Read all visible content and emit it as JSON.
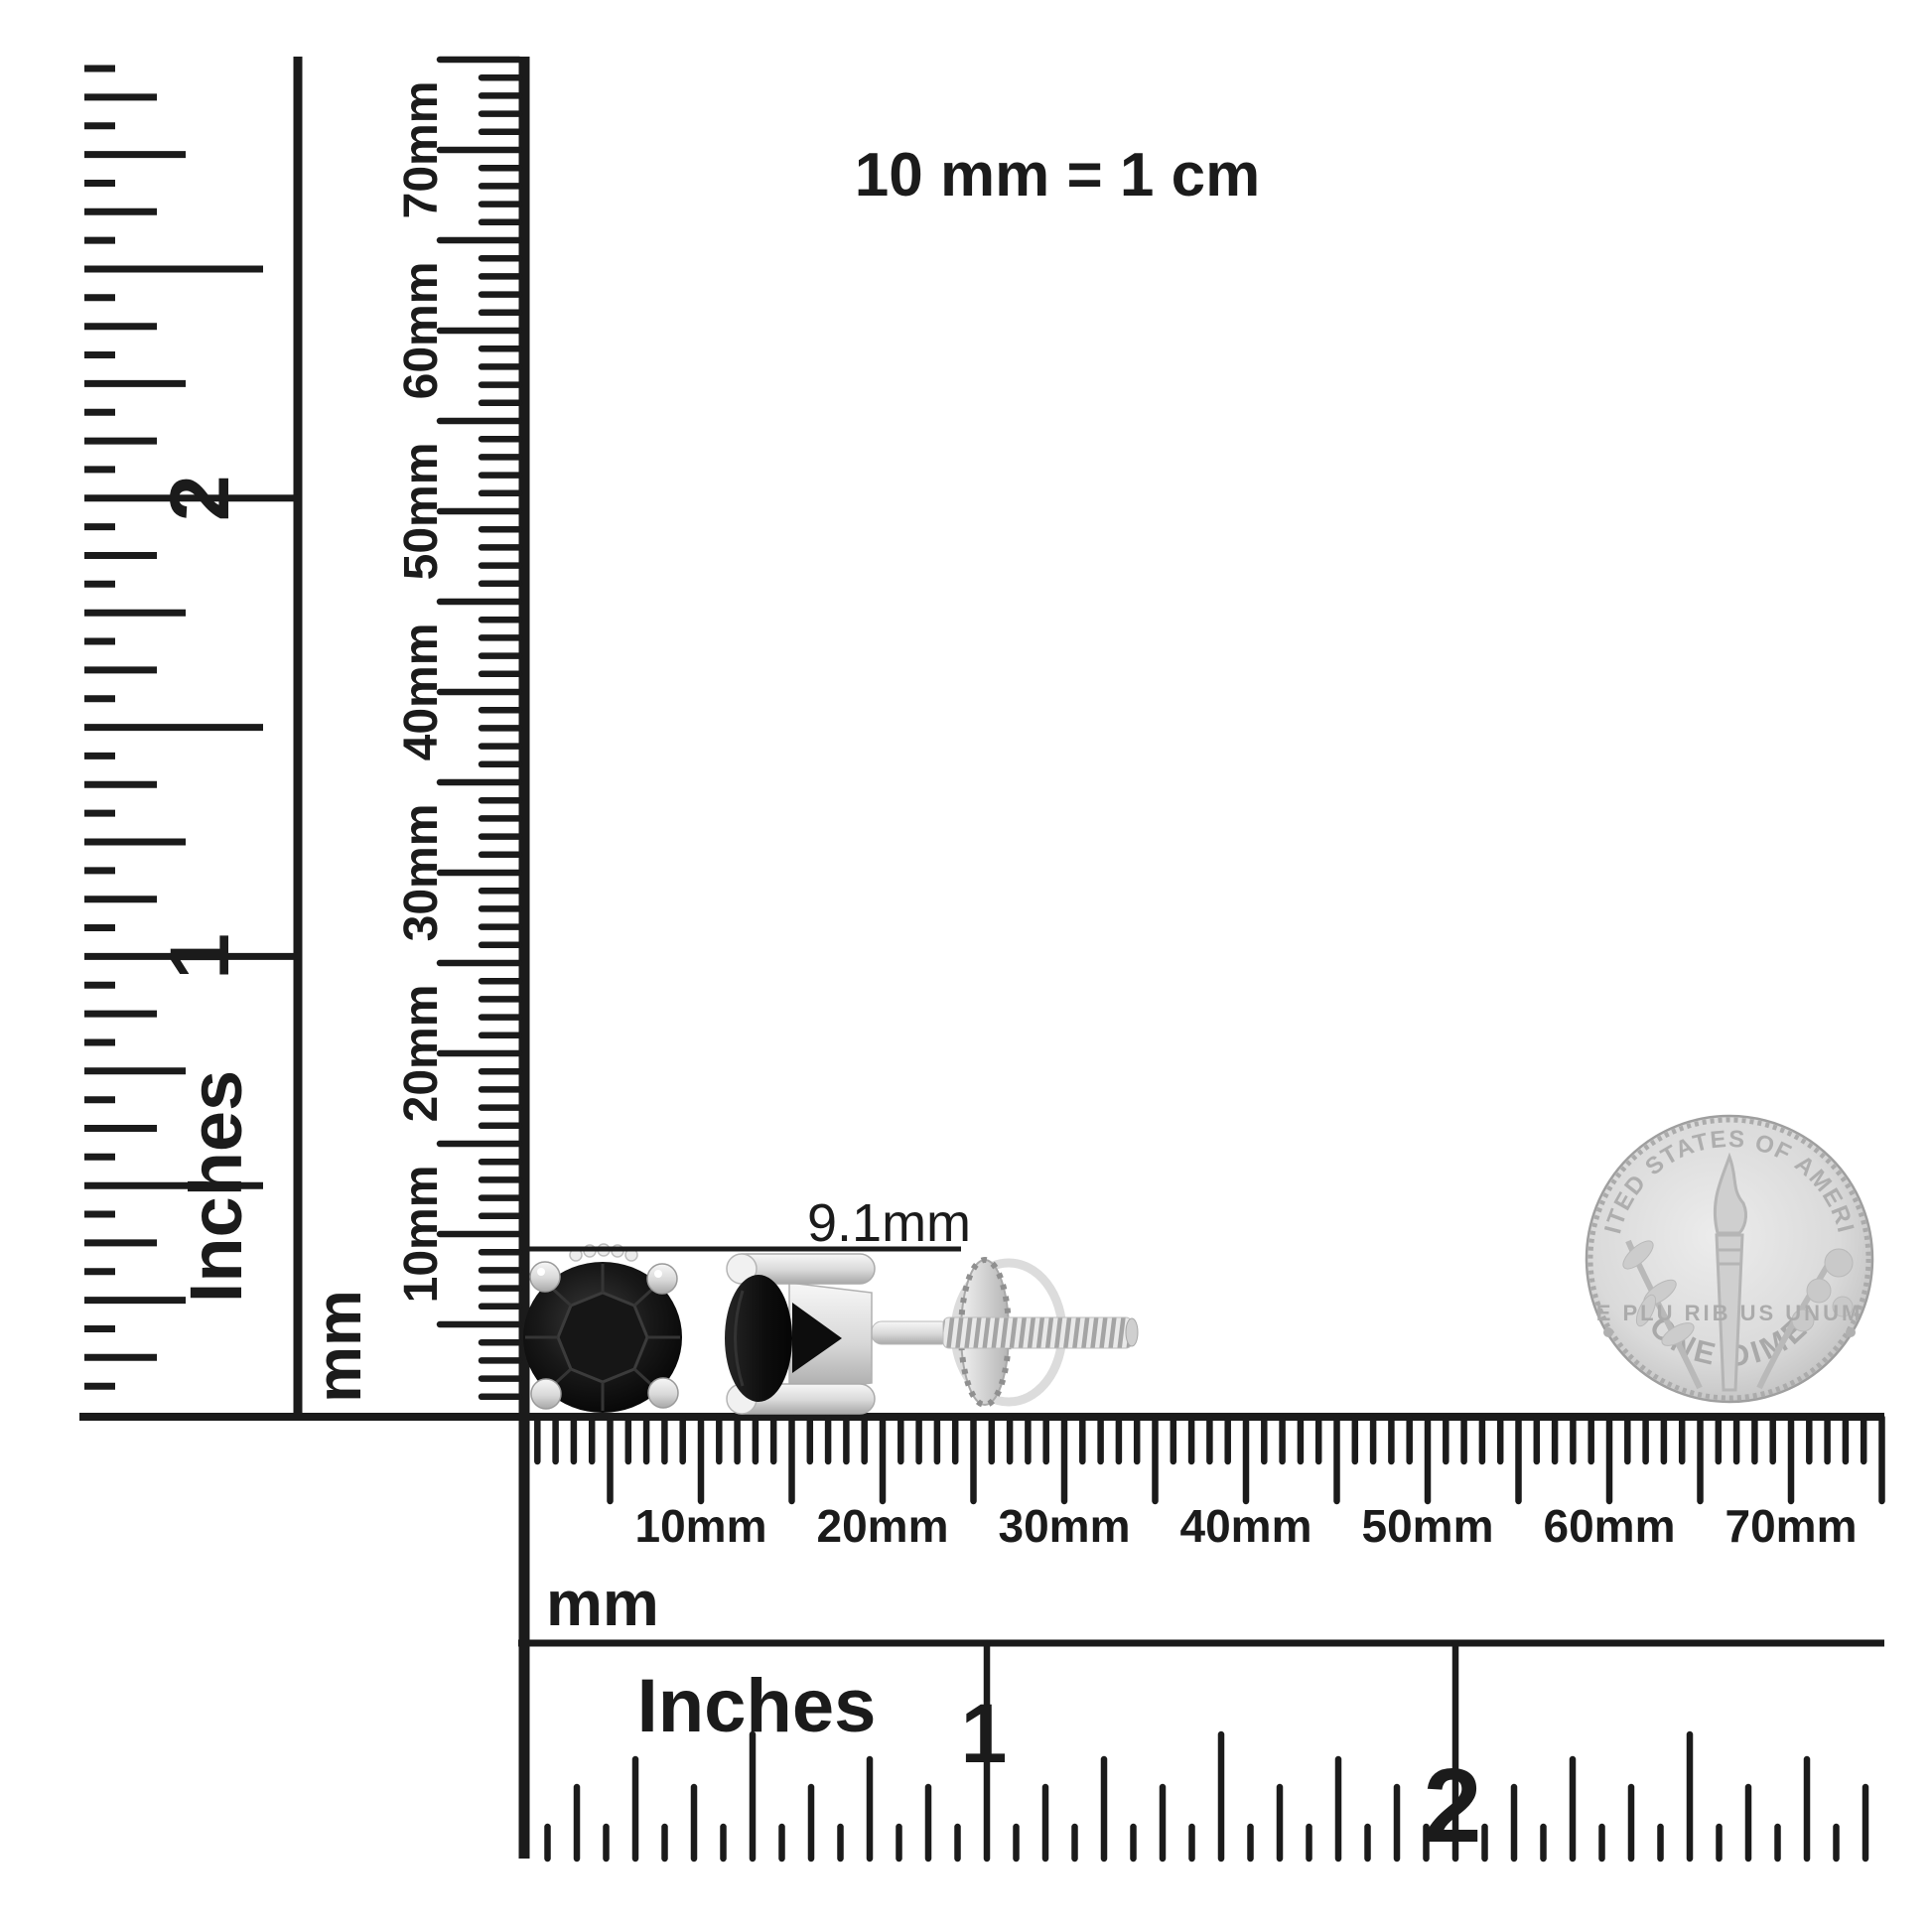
{
  "title_note": "10 mm = 1 cm",
  "measurement": {
    "label": "9.1mm"
  },
  "rulers": {
    "left_inches": {
      "unit": "Inches",
      "numerals": [
        "2",
        "1"
      ]
    },
    "vertical_mm": {
      "unit": "mm",
      "labels": [
        "10mm",
        "20mm",
        "30mm",
        "40mm",
        "50mm",
        "60mm",
        "70mm"
      ]
    },
    "horizontal_mm": {
      "unit": "mm",
      "labels": [
        "10mm",
        "20mm",
        "30mm",
        "40mm",
        "50mm",
        "60mm",
        "70mm"
      ]
    },
    "bottom_inches": {
      "unit": "Inches",
      "numerals": [
        "1",
        "2"
      ]
    }
  },
  "coin": {
    "top_text": "UNITED STATES OF AMERICA",
    "middle_text": "E PLU RIB US UNUM",
    "bottom_text": "ONE DIME"
  },
  "colors": {
    "ink": "#1b1b1b",
    "silver_light": "#f4f4f4",
    "silver_mid": "#c9c9c9",
    "silver_dark": "#9e9e9e",
    "stone_dark": "#0a0a0a",
    "stone_mid": "#2e2e2e",
    "coin_face": "#dcdcdc",
    "coin_detail": "#b3b3b3"
  }
}
